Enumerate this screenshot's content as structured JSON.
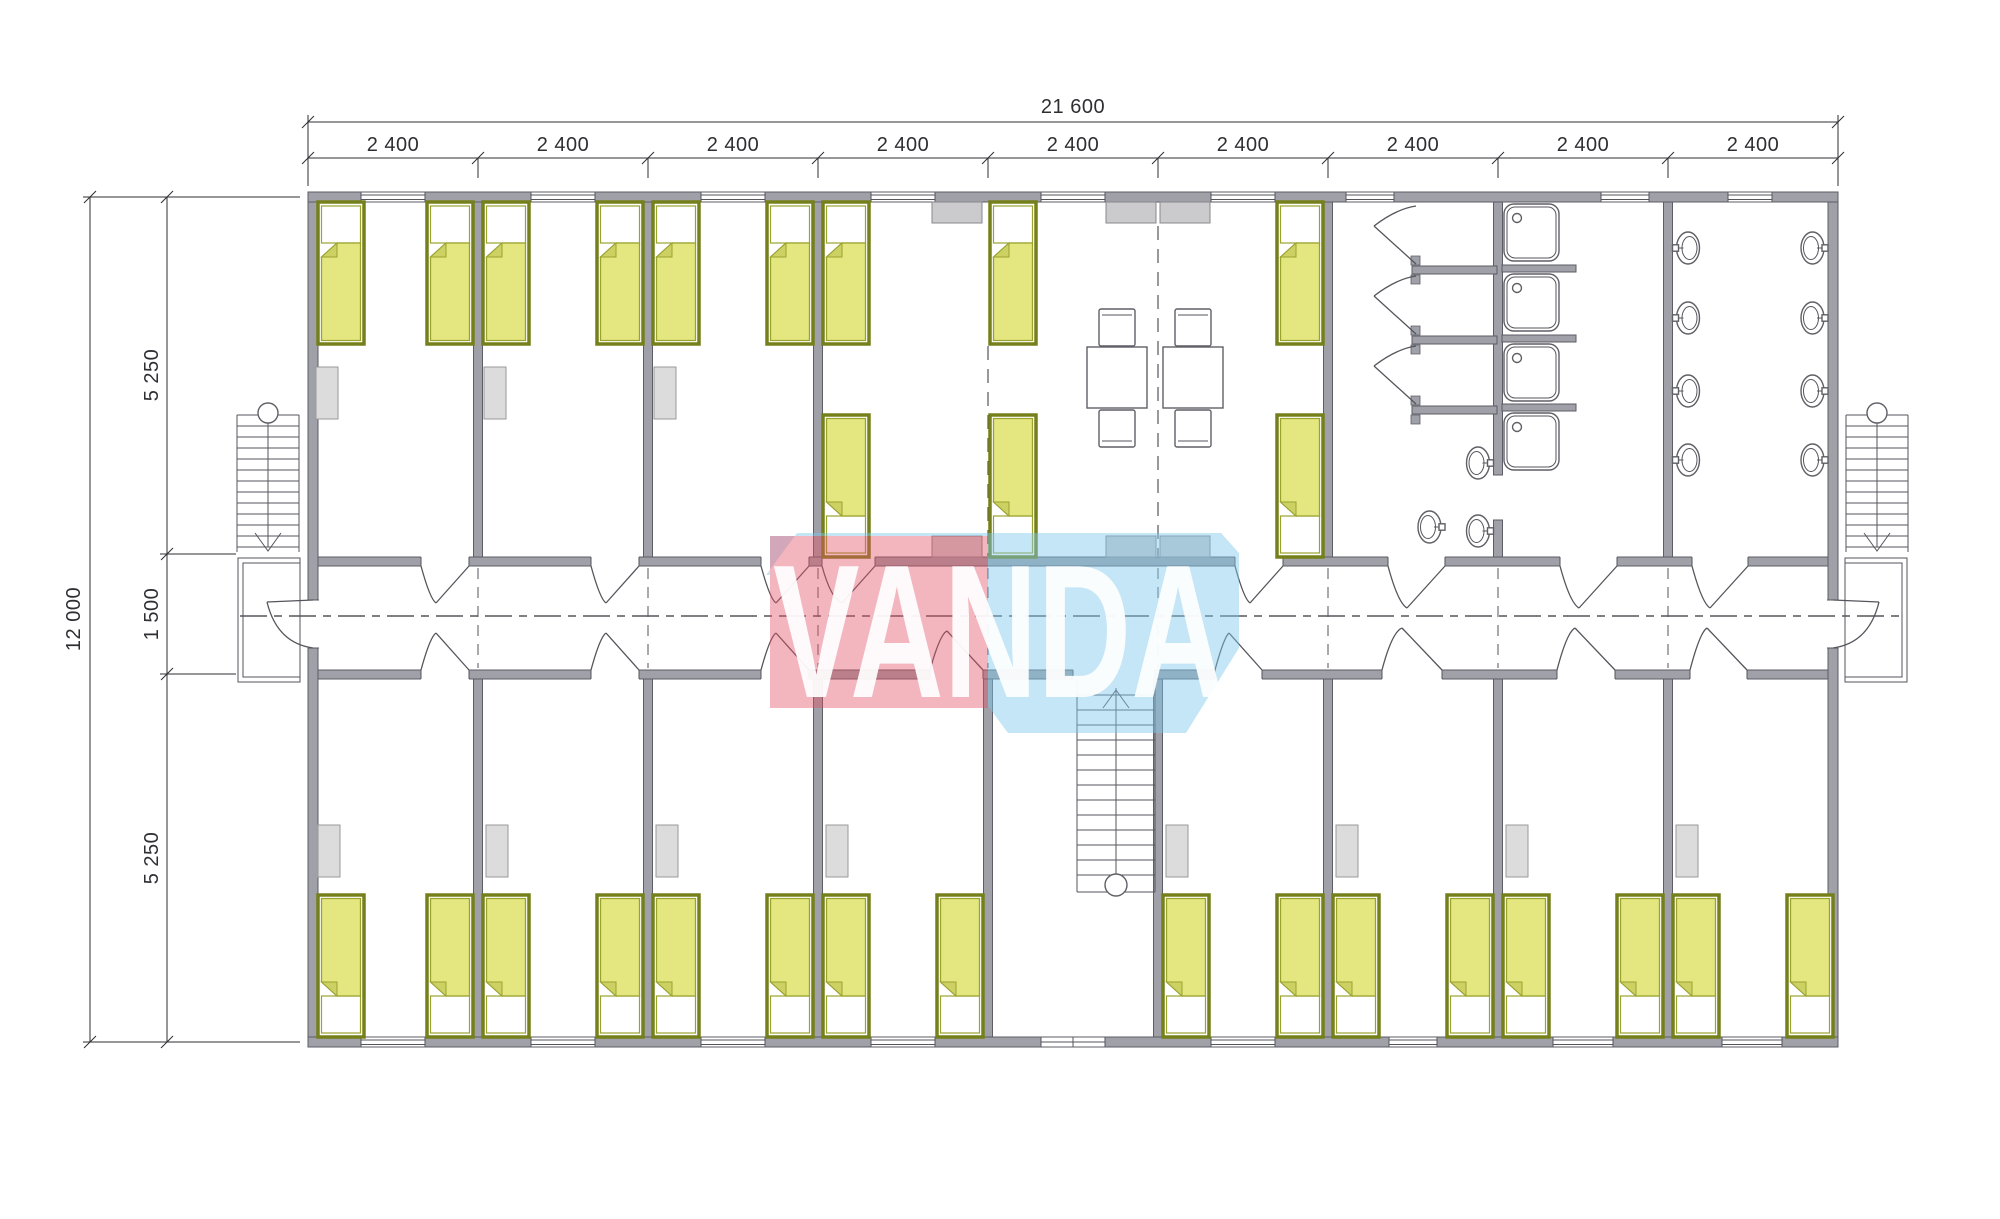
{
  "drawing": {
    "type": "architectural-floor-plan",
    "watermark": {
      "text": "VANDA"
    },
    "dimensions": {
      "top_total": "21 600",
      "top_bays": [
        "2 400",
        "2 400",
        "2 400",
        "2 400",
        "2 400",
        "2 400",
        "2 400",
        "2 400",
        "2 400"
      ],
      "left_total": "12 000",
      "left_segments": [
        "5 250",
        "1 500",
        "5 250"
      ]
    },
    "counts": {
      "beds": 28,
      "tables": 2,
      "chairs": 4,
      "shower_trays": 4,
      "washbasins": 11,
      "wc_stalls": 3,
      "staircases": 3,
      "lockers": 11,
      "cabinets": 6,
      "entrance_landings": 2
    }
  },
  "colors": {
    "wall_fill": "#9fa0a8",
    "wall_stroke": "#5d5d66",
    "line": "#55555c",
    "fixture": "#5f5f66",
    "dim": "#2f2f33",
    "bed_fill": "#e4e680",
    "bed_stroke": "#75801b",
    "bed_soft": "#9aa32e",
    "bed_fold": "#cdd164",
    "locker_fill": "#dcdcdc",
    "locker_stroke": "#9a9a9a",
    "cabinet_fill": "#cbcbcd",
    "cabinet_stroke": "#8a8a8e",
    "logo_red": "#e25064",
    "logo_blue": "#7ec8ec",
    "logo_text": "#ffffff"
  }
}
